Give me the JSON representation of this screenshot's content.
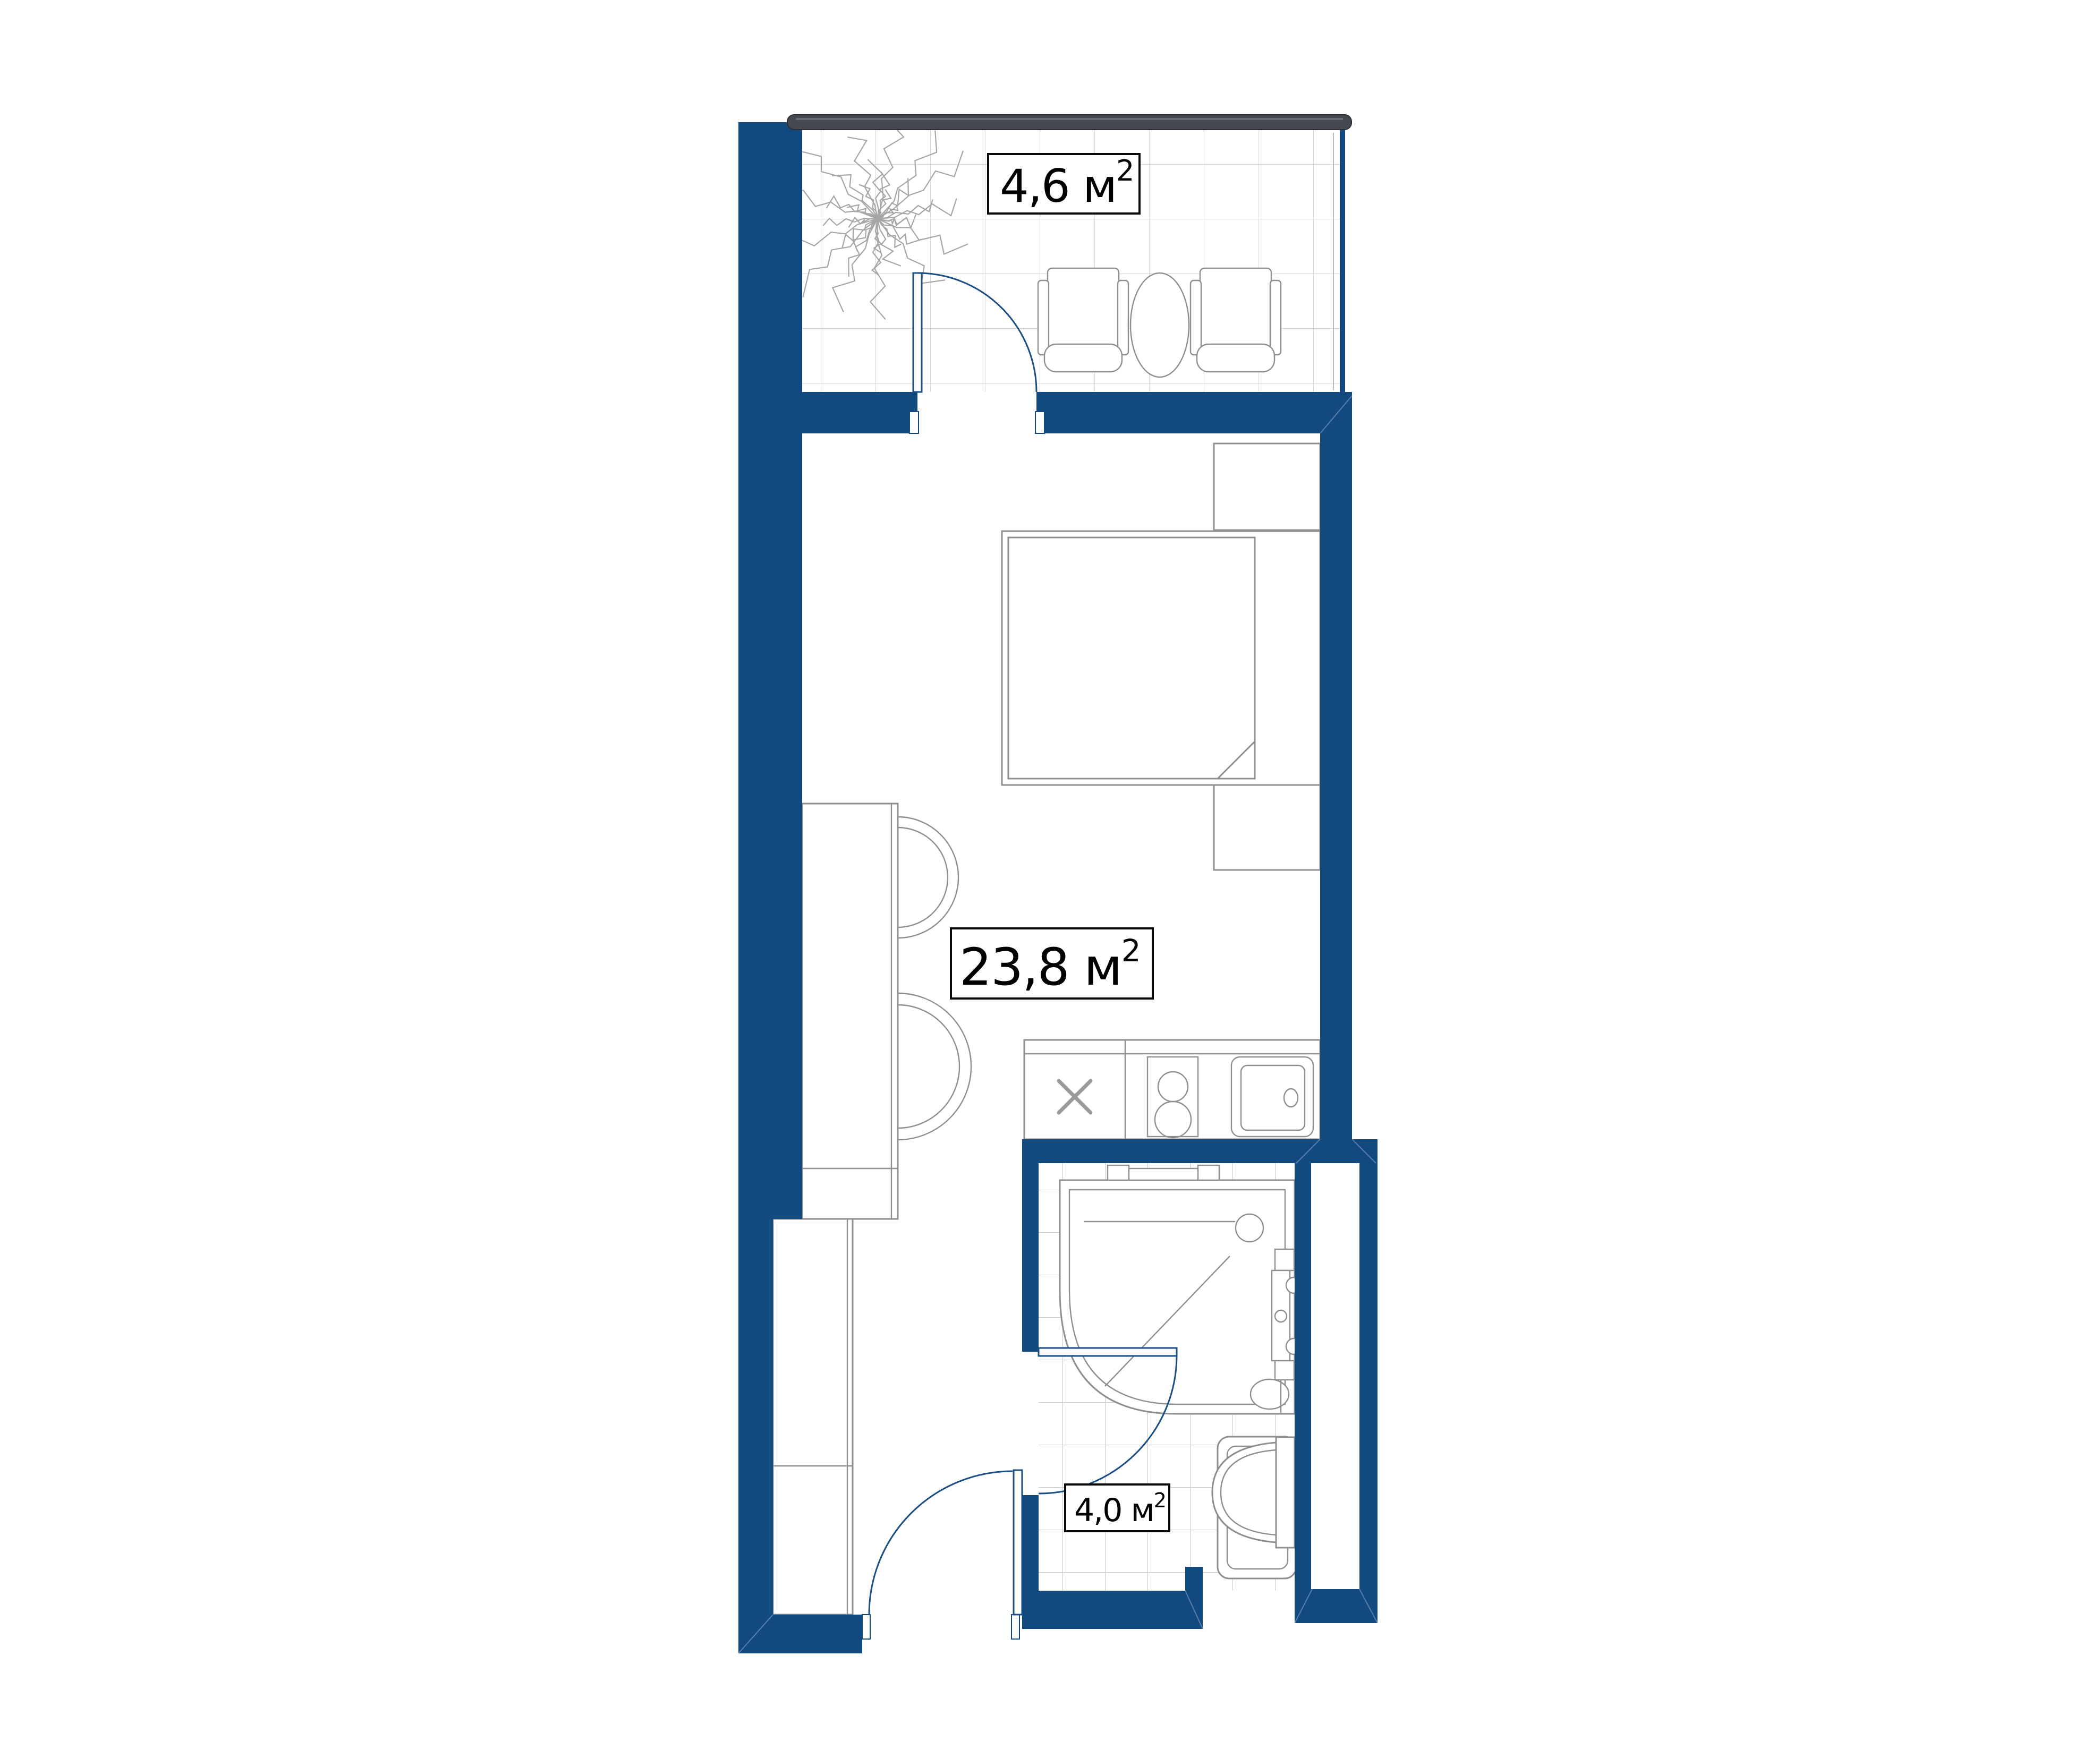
{
  "plan": {
    "type": "apartment-floor-plan",
    "rooms": {
      "balcony": {
        "area_label": "4,6 м",
        "area_exponent": "2"
      },
      "living_room": {
        "area_label": "23,8 м",
        "area_exponent": "2"
      },
      "bathroom": {
        "area_label": "4,0 м",
        "area_exponent": "2"
      }
    },
    "kitchen": {
      "cabinet_symbol": "X"
    },
    "colors": {
      "wall": "#12497F",
      "window_frame": "#45484E",
      "window_frame_dark": "#2B2D31",
      "window_frame_highlight": "#71747A",
      "door_arc": "#1B4E85",
      "furniture_outline": "#8F8F8F",
      "tile_grid_balcony": "#D8D8D8",
      "tile_grid_bathroom": "#C9C9C9",
      "tree": "#A6A6A6",
      "label_border": "#0A0A0A",
      "label_background": "#FFFFFF"
    },
    "furniture": [
      "tree",
      "armchair-left",
      "oval-table",
      "armchair-right",
      "double-bed",
      "nightstand-top",
      "nightstand-bottom",
      "wardrobe",
      "hall-closet",
      "kitchen-counter",
      "hob-two-burner",
      "kitchen-sink",
      "shower-cabin",
      "washbasin",
      "wall-hung-toilet"
    ]
  }
}
